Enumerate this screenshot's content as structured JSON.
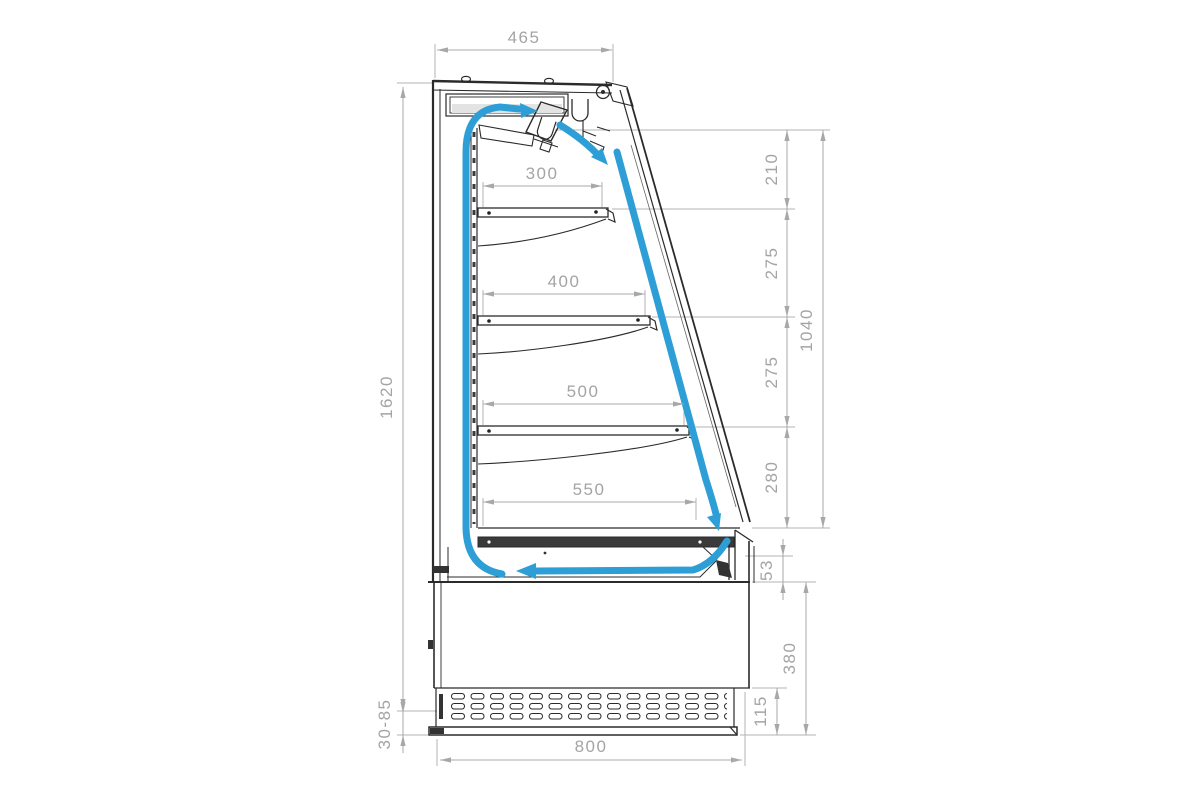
{
  "drawing": {
    "type": "technical-section-drawing",
    "subject": "Open refrigerated display case / wall cooler — side cross-section with air circulation path and shelf dimensions",
    "units": "mm"
  },
  "colors": {
    "airflow": "#2E9FD6",
    "structure": "#2b2b2b",
    "dimension": "#a4a4a4",
    "background": "#ffffff"
  },
  "dims": {
    "top_depth": "465",
    "total_height": "1620",
    "feet_range": "30-85",
    "base_depth": "800",
    "shelf_depth_1": "300",
    "shelf_depth_2": "400",
    "shelf_depth_3": "500",
    "shelf_depth_4": "550",
    "gap_top": "210",
    "gap_1": "275",
    "gap_2": "275",
    "gap_3": "280",
    "opening_height": "1040",
    "bumper_height": "53",
    "base_height": "380",
    "grille_height": "115"
  }
}
